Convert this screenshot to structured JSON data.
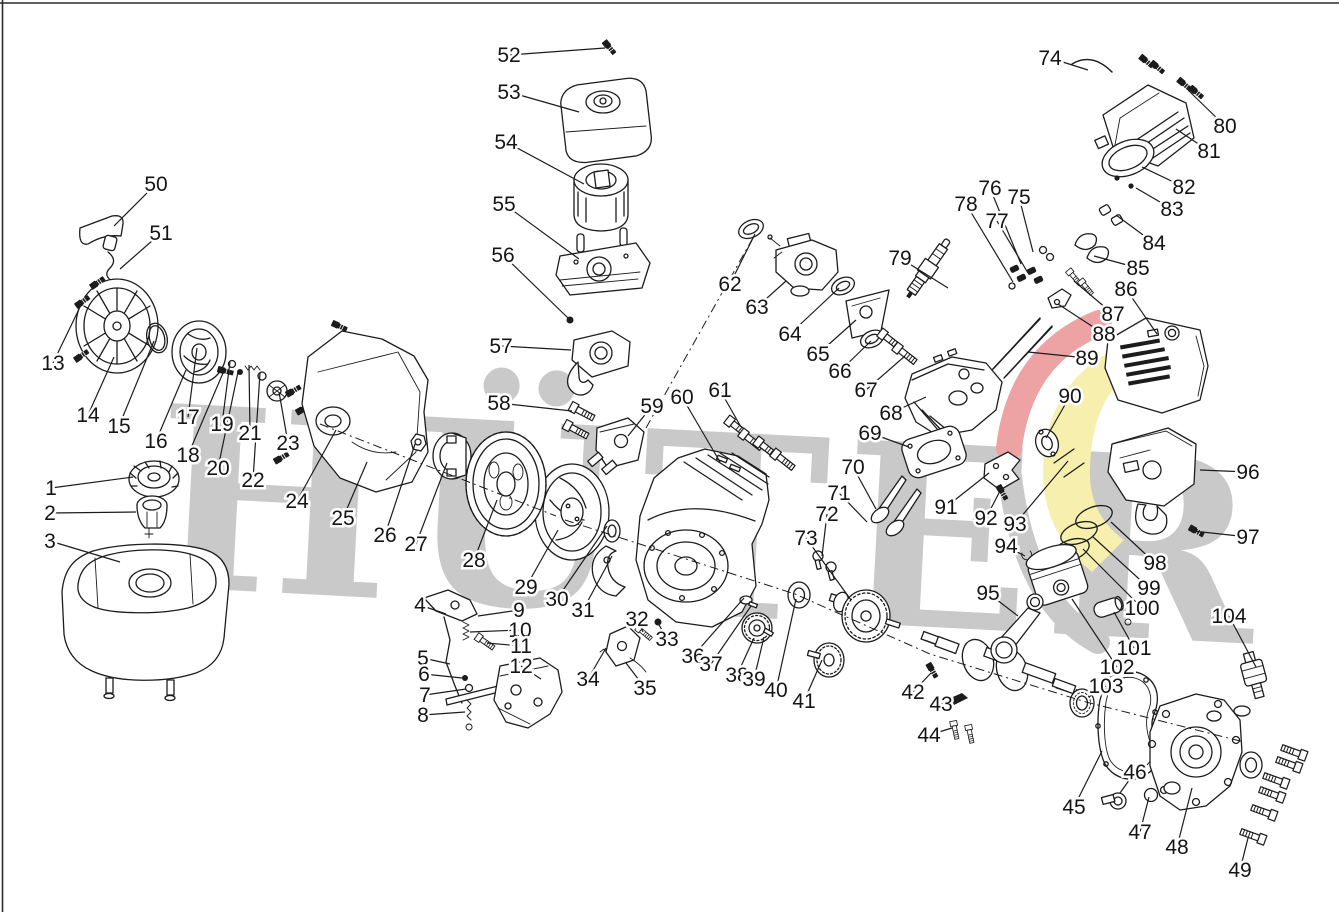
{
  "diagram": {
    "type": "exploded-parts-diagram",
    "subject": "single-cylinder gasoline engine",
    "watermark": {
      "text": "HÜTER",
      "letter_color": "#c9c9c9",
      "swoosh_red": "#eda3a3",
      "swoosh_yellow": "#f6efad",
      "swoosh_gray": "#c9c9c9"
    },
    "callout_count": 104,
    "callouts": [
      [
        1,
        51,
        488,
        133,
        477
      ],
      [
        2,
        50,
        513,
        136,
        512
      ],
      [
        3,
        50,
        541,
        120,
        562
      ],
      [
        4,
        420,
        605,
        446,
        614
      ],
      [
        5,
        423,
        658,
        450,
        664
      ],
      [
        6,
        424,
        674,
        462,
        678
      ],
      [
        7,
        425,
        695,
        466,
        689
      ],
      [
        8,
        423,
        715,
        465,
        712
      ],
      [
        9,
        519,
        610,
        478,
        616
      ],
      [
        10,
        520,
        630,
        470,
        632
      ],
      [
        11,
        521,
        646,
        487,
        643
      ],
      [
        12,
        521,
        666,
        541,
        679
      ],
      [
        13,
        53,
        363,
        81,
        305
      ],
      [
        14,
        88,
        415,
        114,
        357
      ],
      [
        15,
        119,
        426,
        154,
        341
      ],
      [
        16,
        156,
        441,
        186,
        370
      ],
      [
        17,
        188,
        417,
        197,
        348
      ],
      [
        18,
        188,
        455,
        223,
        373
      ],
      [
        19,
        222,
        424,
        230,
        362
      ],
      [
        20,
        218,
        468,
        238,
        372
      ],
      [
        21,
        250,
        433,
        249,
        365
      ],
      [
        22,
        253,
        480,
        260,
        373
      ],
      [
        23,
        288,
        443,
        279,
        392
      ],
      [
        24,
        297,
        501,
        336,
        430
      ],
      [
        25,
        343,
        518,
        367,
        462
      ],
      [
        26,
        385,
        535,
        415,
        444
      ],
      [
        27,
        416,
        544,
        447,
        463
      ],
      [
        28,
        474,
        560,
        497,
        500
      ],
      [
        29,
        526,
        587,
        558,
        530
      ],
      [
        30,
        557,
        599,
        607,
        526
      ],
      [
        31,
        583,
        610,
        612,
        556
      ],
      [
        32,
        637,
        619,
        643,
        632
      ],
      [
        33,
        667,
        639,
        658,
        623
      ],
      [
        34,
        588,
        679,
        606,
        648
      ],
      [
        35,
        645,
        688,
        626,
        663
      ],
      [
        36,
        693,
        656,
        744,
        598
      ],
      [
        37,
        711,
        664,
        751,
        606
      ],
      [
        38,
        737,
        675,
        754,
        638
      ],
      [
        39,
        754,
        679,
        764,
        637
      ],
      [
        40,
        776,
        690,
        796,
        599
      ],
      [
        41,
        804,
        701,
        822,
        660
      ],
      [
        42,
        913,
        692,
        931,
        673
      ],
      [
        43,
        941,
        704,
        956,
        700
      ],
      [
        44,
        929,
        735,
        952,
        728
      ],
      [
        45,
        1074,
        807,
        1102,
        751
      ],
      [
        46,
        1135,
        772,
        1120,
        793
      ],
      [
        47,
        1140,
        832,
        1149,
        797
      ],
      [
        48,
        1177,
        847,
        1192,
        788
      ],
      [
        49,
        1240,
        870,
        1248,
        838
      ],
      [
        50,
        156,
        184,
        114,
        226
      ],
      [
        51,
        161,
        233,
        120,
        269
      ],
      [
        52,
        509,
        55,
        605,
        48
      ],
      [
        53,
        509,
        92,
        579,
        112
      ],
      [
        54,
        506,
        142,
        584,
        184
      ],
      [
        55,
        504,
        204,
        579,
        259
      ],
      [
        56,
        503,
        255,
        568,
        318
      ],
      [
        57,
        501,
        346,
        571,
        350
      ],
      [
        58,
        499,
        403,
        572,
        411
      ],
      [
        59,
        652,
        406,
        628,
        436
      ],
      [
        60,
        682,
        397,
        720,
        462
      ],
      [
        61,
        720,
        390,
        741,
        427
      ],
      [
        62,
        730,
        284,
        755,
        234
      ],
      [
        63,
        757,
        307,
        786,
        281
      ],
      [
        64,
        790,
        334,
        839,
        288
      ],
      [
        65,
        818,
        354,
        856,
        320
      ],
      [
        66,
        840,
        371,
        871,
        341
      ],
      [
        67,
        866,
        390,
        905,
        356
      ],
      [
        68,
        891,
        413,
        926,
        397
      ],
      [
        69,
        870,
        433,
        909,
        447
      ],
      [
        70,
        853,
        467,
        876,
        509
      ],
      [
        71,
        839,
        493,
        867,
        522
      ],
      [
        72,
        827,
        514,
        822,
        556
      ],
      [
        73,
        806,
        538,
        851,
        600
      ],
      [
        74,
        1050,
        58,
        1088,
        70
      ],
      [
        75,
        1019,
        197,
        1033,
        252
      ],
      [
        76,
        990,
        188,
        1021,
        264
      ],
      [
        77,
        997,
        221,
        1028,
        273
      ],
      [
        78,
        966,
        204,
        1013,
        282
      ],
      [
        79,
        900,
        258,
        948,
        288
      ],
      [
        80,
        1225,
        126,
        1188,
        90
      ],
      [
        81,
        1209,
        151,
        1176,
        129
      ],
      [
        82,
        1184,
        187,
        1142,
        167
      ],
      [
        83,
        1172,
        209,
        1136,
        188
      ],
      [
        84,
        1154,
        243,
        1116,
        215
      ],
      [
        85,
        1138,
        268,
        1094,
        256
      ],
      [
        86,
        1126,
        289,
        1157,
        334
      ],
      [
        87,
        1113,
        314,
        1074,
        281
      ],
      [
        88,
        1104,
        334,
        1058,
        304
      ],
      [
        89,
        1087,
        358,
        1028,
        352
      ],
      [
        90,
        1070,
        396,
        1046,
        438
      ],
      [
        91,
        946,
        507,
        989,
        473
      ],
      [
        92,
        986,
        518,
        1000,
        491
      ],
      [
        93,
        1015,
        524,
        1068,
        461
      ],
      [
        94,
        1006,
        546,
        1025,
        556
      ],
      [
        95,
        988,
        593,
        1018,
        616
      ],
      [
        96,
        1248,
        472,
        1200,
        470
      ],
      [
        97,
        1248,
        537,
        1193,
        531
      ],
      [
        98,
        1155,
        563,
        1111,
        522
      ],
      [
        99,
        1149,
        588,
        1092,
        536
      ],
      [
        100,
        1142,
        608,
        1083,
        549
      ],
      [
        101,
        1134,
        648,
        1114,
        612
      ],
      [
        102,
        1117,
        667,
        1072,
        599
      ],
      [
        103,
        1106,
        686,
        1089,
        697
      ],
      [
        104,
        1229,
        616,
        1256,
        667
      ]
    ]
  }
}
